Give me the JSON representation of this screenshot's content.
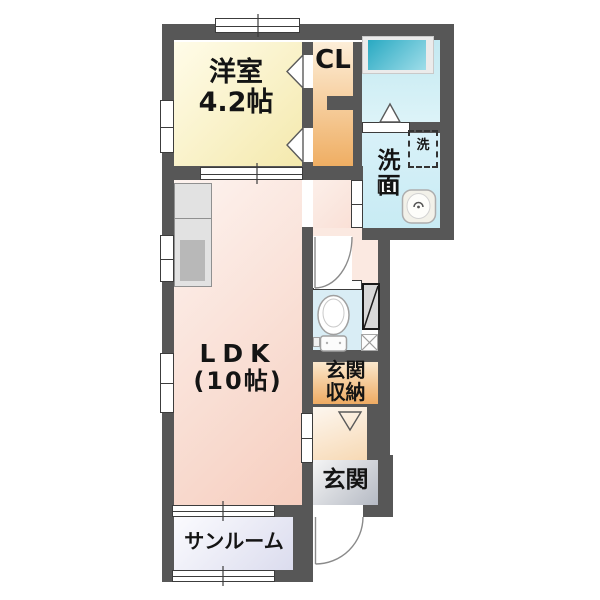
{
  "floorplan": {
    "rooms": {
      "western_room": {
        "name": "洋室",
        "size": "4.2帖"
      },
      "closet": {
        "label": "CL"
      },
      "washroom": {
        "label": "洗面"
      },
      "washer": {
        "label": "洗"
      },
      "ldk": {
        "name": "LDK",
        "size": "(10帖)"
      },
      "entrance_storage": {
        "line1": "玄関",
        "line2": "収納"
      },
      "entrance": {
        "label": "玄関"
      },
      "sunroom": {
        "label": "サンルーム"
      }
    },
    "colors": {
      "wall": "#575757",
      "western_room_fill": "#f4e9ad",
      "closet_fill": "#efae63",
      "bath_fill": "#cdeaf2",
      "bathtub_fill": "#2fb0c6",
      "washroom_fill": "#d6f0f7",
      "ldk_fill": "#f6cebf",
      "toilet_fill": "#d9edf5",
      "entrance_storage_fill": "#eea85d",
      "hall_fill": "#f7d9b4",
      "entrance_fill": "#b5bac4",
      "sunroom_fill": "#dbdcee"
    }
  }
}
